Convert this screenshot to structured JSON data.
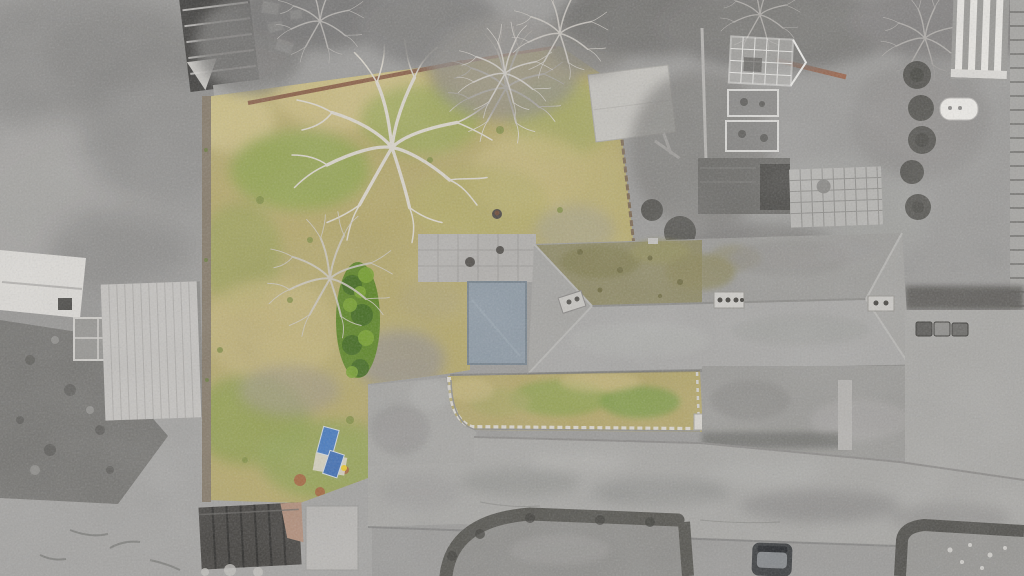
{
  "image": {
    "type": "aerial drone photograph",
    "orientation": "top-down",
    "subject": "residential plot with long hipped-roof house and large rear garden",
    "effect": "property shown in colour while all surrounding land is desaturated to greyscale"
  },
  "palette": {
    "ground_grey": "#9b9a98",
    "canopy_grey": "#787876",
    "garden_grass": "#b3a76c",
    "grass_green": "#93a254",
    "grass_tan": "#c8ba82",
    "bush_green": "#5d8427",
    "roof_grey": "#a4a3a0",
    "roof_moss": "#8d8760",
    "extension_roof": "#8d99a4",
    "concrete_pad": "#c3c1bc",
    "paving_grey": "#b1afac",
    "road_asphalt": "#a7a6a3",
    "hedge_dark": "#55544f",
    "stone_wall": "#d9d5cd",
    "fence_brown": "#8a6047",
    "blue_panels": "#4679bd",
    "shed_roof": "#454340",
    "shed_ridge": "#b08d79",
    "white_structure": "#e9e7e3",
    "car_body": "#3c3e40",
    "deck_grey": "#c4c2bf"
  },
  "scene": {
    "property": {
      "rear_garden": "large lawn of dry tan grass with green patches",
      "trees": [
        "large bare deciduous tree",
        "small bare tree by top fence",
        "bare tree beside conifers"
      ],
      "bushes": "column of dark green conifers",
      "concrete_pad": "light concrete slab in upper lawn",
      "house": "long grey hipped roof, mossy left slope, two chimney stacks",
      "extension": "blue-grey flat roof against left gable",
      "front_garden": "grass strip behind curved low stone wall",
      "blue_panels": "two blue panels lying on boards near the driveway"
    },
    "surroundings": {
      "north": "tree canopy and neighbouring house with dark striped roof and white garden furniture",
      "east": "greenhouse, two cold frames, garage roof, paved patio, shrub row, white oil tank, striped deck",
      "south": "road junction, hedge-lined driveways, parked car, dark-roofed garden shed",
      "west": "neighbouring house with pale decking and mottled grey lawn"
    }
  }
}
